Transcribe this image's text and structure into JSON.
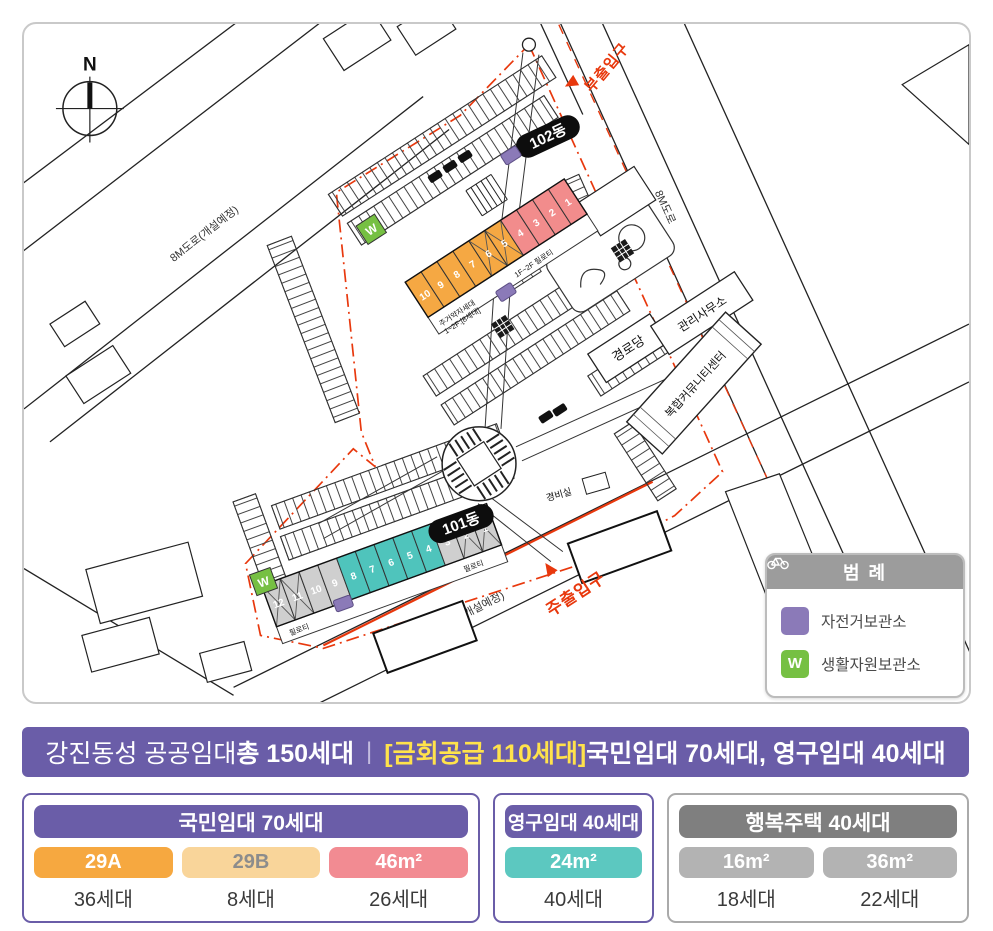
{
  "banner": {
    "bg": "#6a5da8",
    "part1": "강진동성 공공임대 ",
    "part1_bold": "총 150세대",
    "separator": "|",
    "highlight": "[금회공급 110세대]",
    "highlight_color": "#ffe24b",
    "part2": " 국민임대 70세대, 영구임대 40세대"
  },
  "cards": [
    {
      "header": "국민임대 70세대",
      "header_bg": "#6a5da8",
      "border": "#6a5da8",
      "chips": [
        {
          "label": "29A",
          "bg": "#f6a840",
          "fg": "#ffffff",
          "count": "36세대"
        },
        {
          "label": "29B",
          "bg": "#f9d59a",
          "fg": "#8c8c8c",
          "count": "8세대"
        },
        {
          "label": "46m²",
          "bg": "#f28b92",
          "fg": "#ffffff",
          "count": "26세대"
        }
      ]
    },
    {
      "header": "영구임대 40세대",
      "header_bg": "#6a5da8",
      "border": "#6a5da8",
      "chips": [
        {
          "label": "24m²",
          "bg": "#5cc8c0",
          "fg": "#ffffff",
          "count": "40세대"
        }
      ]
    },
    {
      "header": "행복주택 40세대",
      "header_bg": "#7f7f7f",
      "border": "#aaaaaa",
      "chips": [
        {
          "label": "16m²",
          "bg": "#b3b3b3",
          "fg": "#ffffff",
          "count": "18세대"
        },
        {
          "label": "36m²",
          "bg": "#b3b3b3",
          "fg": "#ffffff",
          "count": "22세대"
        }
      ]
    }
  ],
  "map": {
    "north_label": "N",
    "roads": {
      "left": "8M도로(개설예정)",
      "right": "8M도로",
      "bottom": "8M도로(개설예정)"
    },
    "entrances": {
      "main": "주출입구",
      "sub": "부출입구",
      "color": "#e8380d"
    },
    "labels": {
      "b102": "102동",
      "b101": "101동",
      "senior_center": "경로당",
      "mgmt_office": "관리사무소",
      "community_center": "복합커뮤니티센터",
      "security": "경비실",
      "weak_household_1": "주거약자세대",
      "weak_household_2": "1~2F:[8세대]",
      "piloti_note": "1F~2F 필로티",
      "piloti": "필로티",
      "w_box": "W"
    },
    "unit_colors": {
      "29a": "#f5a843",
      "46": "#f28c8c",
      "24": "#4fc4bc",
      "gray": "#cfcfcf"
    },
    "units_102": [
      {
        "no": "10",
        "type": "29a"
      },
      {
        "no": "9",
        "type": "29a"
      },
      {
        "no": "8",
        "type": "29a"
      },
      {
        "no": "7",
        "type": "29a"
      },
      {
        "no": "6",
        "type": "29a",
        "x": true
      },
      {
        "no": "5",
        "type": "29a",
        "x": true
      },
      {
        "no": "4",
        "type": "46"
      },
      {
        "no": "3",
        "type": "46"
      },
      {
        "no": "2",
        "type": "46"
      },
      {
        "no": "1",
        "type": "46"
      }
    ],
    "units_101": [
      {
        "no": "12",
        "type": "gray",
        "x": true
      },
      {
        "no": "11",
        "type": "gray",
        "x": true
      },
      {
        "no": "10",
        "type": "gray"
      },
      {
        "no": "9",
        "type": "gray"
      },
      {
        "no": "8",
        "type": "24"
      },
      {
        "no": "7",
        "type": "24"
      },
      {
        "no": "6",
        "type": "24"
      },
      {
        "no": "5",
        "type": "24"
      },
      {
        "no": "4",
        "type": "24"
      },
      {
        "no": "3",
        "type": "gray"
      },
      {
        "no": "2",
        "type": "gray",
        "x": true
      },
      {
        "no": "1",
        "type": "gray",
        "x": true
      }
    ],
    "legend": {
      "title": "범 례",
      "items": [
        {
          "label": "자전거보관소",
          "color": "#8b7ab8",
          "icon": "bicycle"
        },
        {
          "label": "생활자원보관소",
          "color": "#76c043",
          "icon": "W"
        }
      ]
    }
  }
}
